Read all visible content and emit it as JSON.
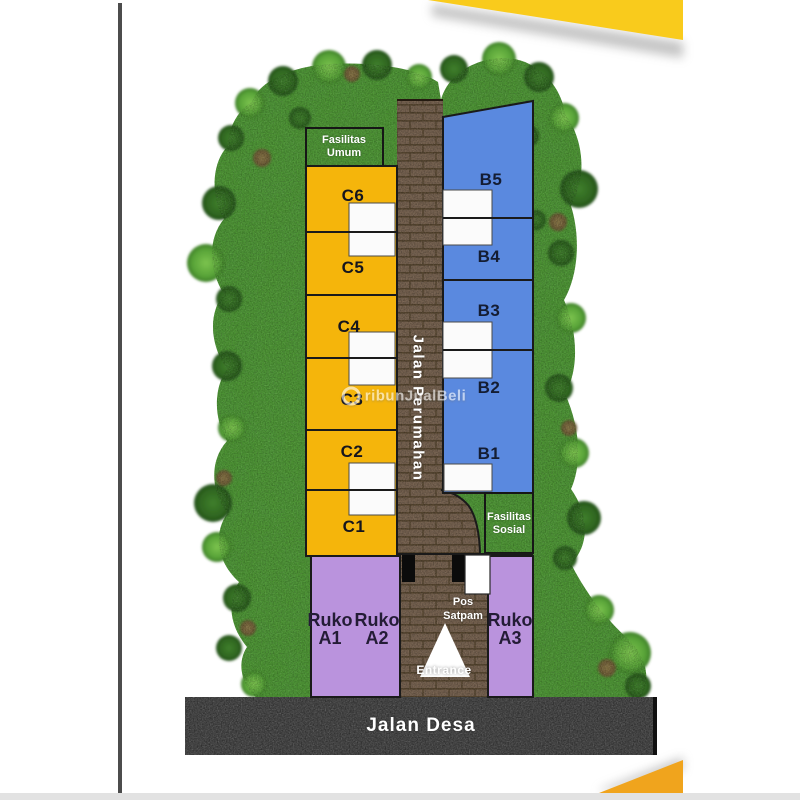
{
  "frame": {
    "accent_yellow_top": "#F9CB1C",
    "accent_orange_bottom": "#F0A41D",
    "left_line_color": "#4C4C4C",
    "bottom_strip_color": "#E2E2E2"
  },
  "watermark": {
    "text": "ribunJualBeli"
  },
  "site_plan": {
    "facility_public": {
      "line1": "Fasilitas",
      "line2": "Umum"
    },
    "facility_social": {
      "line1": "Fasilitas",
      "line2": "Sosial"
    },
    "main_road": "Jalan Perumahan",
    "village_road": "Jalan Desa",
    "guard_post": {
      "line1": "Pos",
      "line2": "Satpam"
    },
    "entrance": "Entrance",
    "units_c": [
      "C6",
      "C5",
      "C4",
      "C3",
      "C2",
      "C1"
    ],
    "units_b": [
      "B5",
      "B4",
      "B3",
      "B2",
      "B1"
    ],
    "shophouses": [
      {
        "line1": "Ruko",
        "line2": "A1"
      },
      {
        "line1": "Ruko",
        "line2": "A2"
      },
      {
        "line1": "Ruko",
        "line2": "A3"
      }
    ],
    "colors": {
      "block_c": "#F5B50B",
      "block_b": "#5A89DF",
      "block_ruko": "#BA93DD",
      "grass": "#4D9434",
      "road_brown": "#75614F",
      "road_asphalt": "#474747",
      "carport": "#FBFBFB"
    }
  }
}
